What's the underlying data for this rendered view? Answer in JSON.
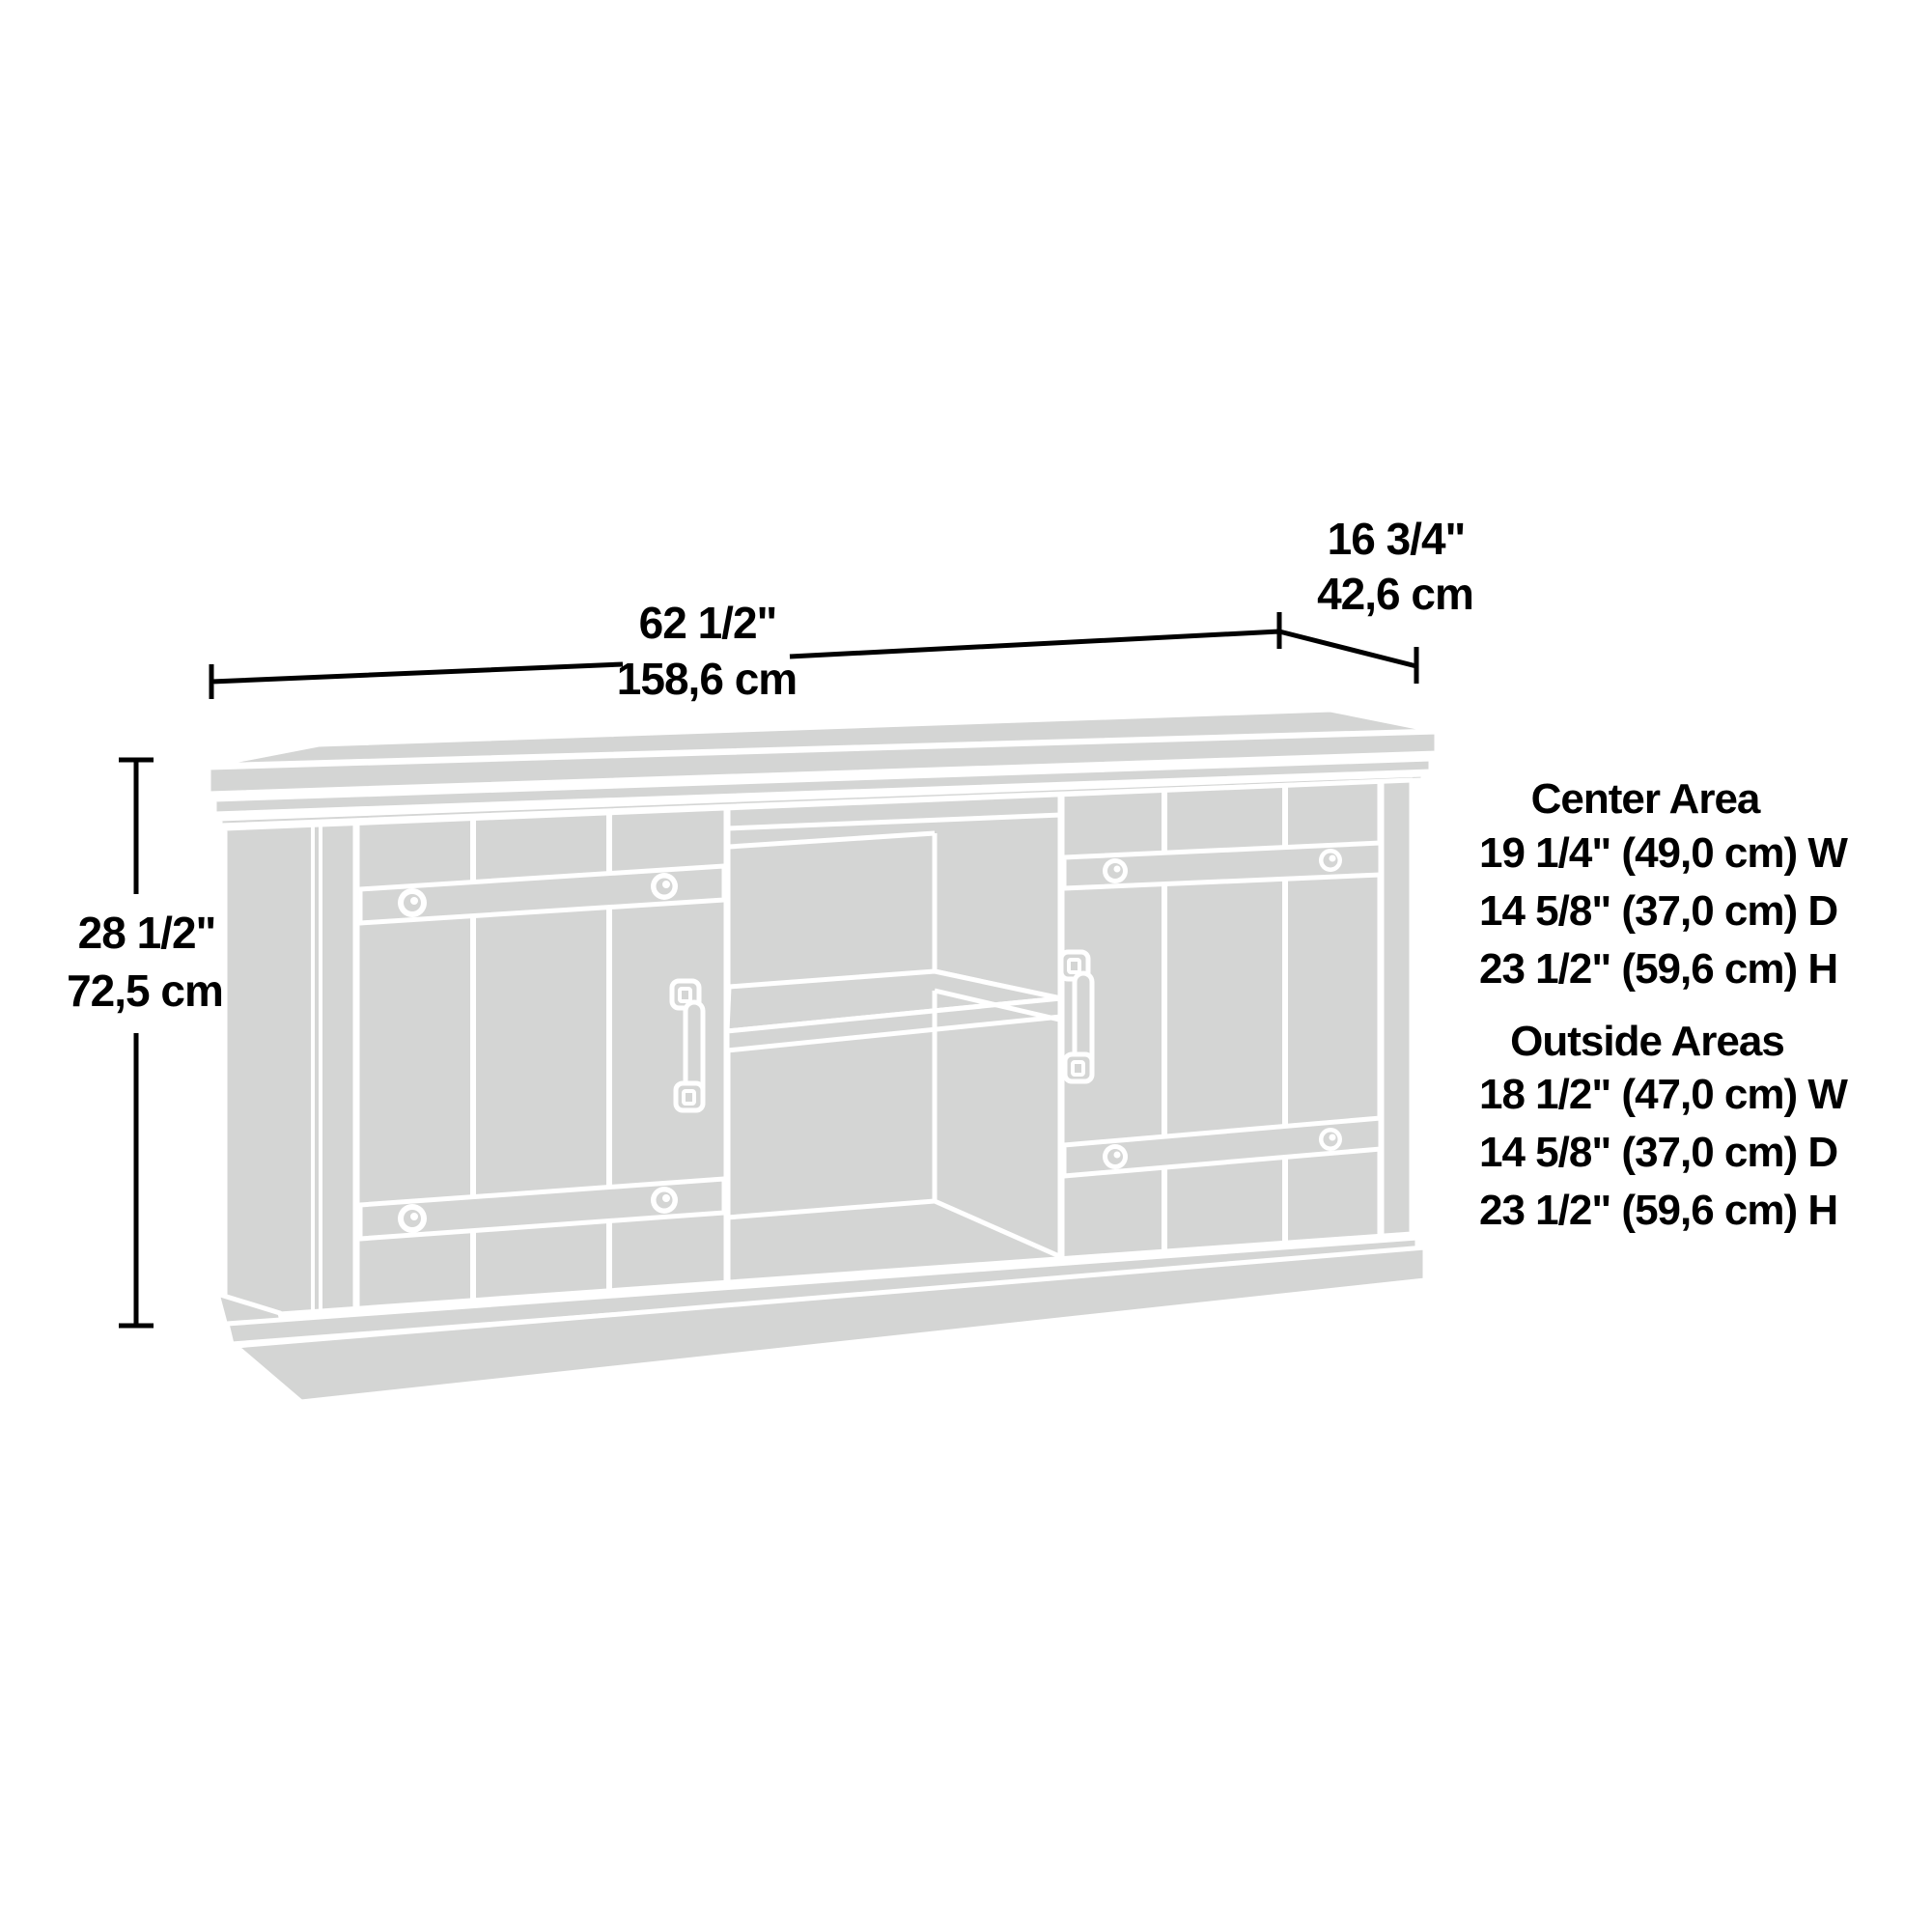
{
  "diagram": {
    "dimensions": {
      "width": {
        "inches": "62 1/2\"",
        "metric": "158,6 cm"
      },
      "depth": {
        "inches": "16 3/4\"",
        "metric": "42,6 cm"
      },
      "height": {
        "inches": "28 1/2\"",
        "metric": "72,5 cm"
      }
    },
    "areas": {
      "center": {
        "title": "Center Area",
        "specs": [
          "19 1/4\" (49,0 cm) W",
          "14 5/8\" (37,0 cm) D",
          "23 1/2\" (59,6 cm) H"
        ]
      },
      "outside": {
        "title": "Outside Areas",
        "specs": [
          "18 1/2\" (47,0 cm) W",
          "14 5/8\" (37,0 cm) D",
          "23 1/2\" (59,6 cm) H"
        ]
      }
    },
    "colors": {
      "furniture_fill": "#d4d5d4",
      "outline": "#ffffff",
      "dimension_color": "#000000",
      "background": "#ffffff"
    }
  }
}
